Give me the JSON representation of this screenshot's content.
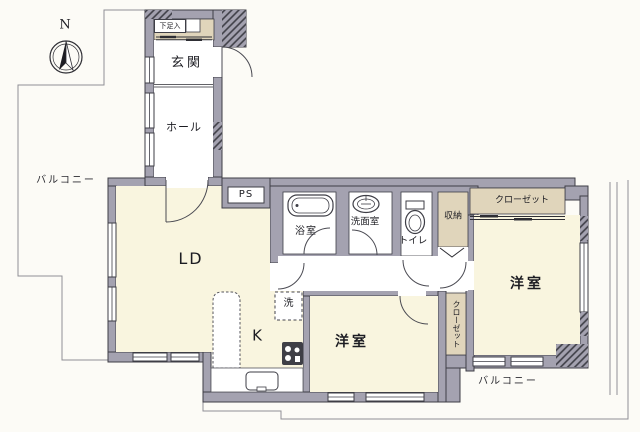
{
  "figure": "apartment-floor-plan",
  "compass": {
    "north_label": "N"
  },
  "labels": {
    "shoe_box": "下足入",
    "entrance": "玄関",
    "hall": "ホール",
    "balcony_left": "バルコニー",
    "balcony_bottom": "バルコニー",
    "pipe_space": "PS",
    "bathroom": "浴室",
    "washroom": "洗面室",
    "toilet": "トイレ",
    "storage": "収納",
    "closet_top": "クローゼット",
    "closet_middle": "クローゼット",
    "living_dining": "LD",
    "kitchen": "K",
    "laundry": "洗",
    "bedroom_right": "洋室",
    "bedroom_bottom": "洋室"
  },
  "colors": {
    "wall": "#a4a2b0",
    "room_cream": "#f9f5df",
    "closet_beige": "#e0d5bb",
    "outline": "#3e3e46",
    "background": "#fcfbf6"
  }
}
